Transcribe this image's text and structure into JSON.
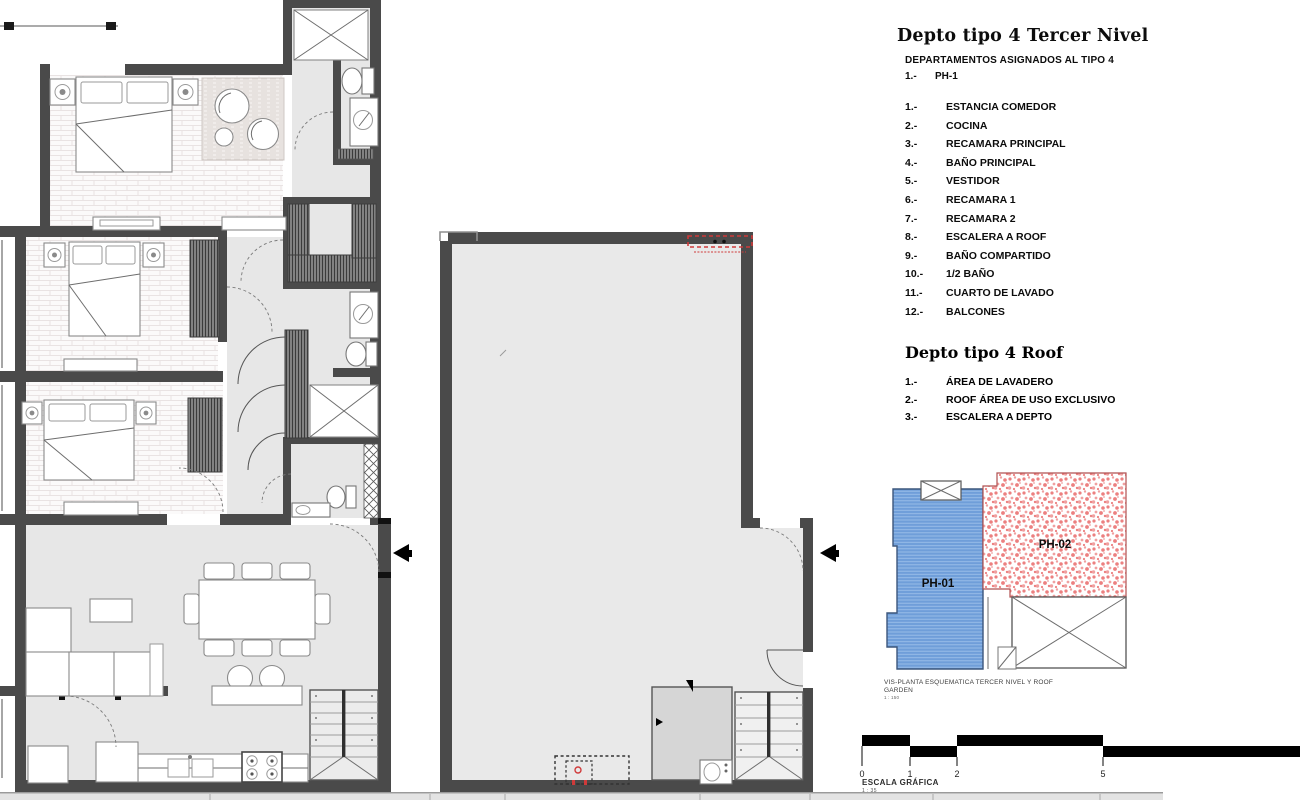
{
  "legend": {
    "title": "Depto tipo 4 Tercer Nivel",
    "subtitle": "DEPARTAMENTOS ASIGNADOS AL TIPO 4",
    "assignment": {
      "num": "1.-",
      "label": "PH-1"
    },
    "rooms": [
      {
        "num": "1.-",
        "label": "ESTANCIA COMEDOR"
      },
      {
        "num": "2.-",
        "label": "COCINA"
      },
      {
        "num": "3.-",
        "label": "RECAMARA PRINCIPAL"
      },
      {
        "num": "4.-",
        "label": "BAÑO PRINCIPAL"
      },
      {
        "num": "5.-",
        "label": "VESTIDOR"
      },
      {
        "num": "6.-",
        "label": "RECAMARA 1"
      },
      {
        "num": "7.-",
        "label": "RECAMARA 2"
      },
      {
        "num": "8.-",
        "label": "ESCALERA A ROOF"
      },
      {
        "num": "9.-",
        "label": "BAÑO COMPARTIDO"
      },
      {
        "num": "10.-",
        "label": "1/2 BAÑO"
      },
      {
        "num": "11.-",
        "label": "CUARTO DE LAVADO"
      },
      {
        "num": "12.-",
        "label": "BALCONES"
      }
    ],
    "roof_title": "Depto tipo 4 Roof",
    "roof_rooms": [
      {
        "num": "1.-",
        "label": "ÁREA DE LAVADERO"
      },
      {
        "num": "2.-",
        "label": "ROOF ÁREA DE USO EXCLUSIVO"
      },
      {
        "num": "3.-",
        "label": "ESCALERA A DEPTO"
      }
    ]
  },
  "schematic": {
    "ph01_label": "PH-01",
    "ph02_label": "PH-02",
    "caption_line1": "VIS-PLANTA ESQUEMATICA TERCER NIVEL Y ROOF",
    "caption_line2": "GARDEN",
    "caption_scale": "1 : 150"
  },
  "scale_bar": {
    "ticks": [
      "0",
      "1",
      "2",
      "5"
    ],
    "label": "ESCALA GRÁFICA",
    "ratio": "1 : 35"
  },
  "colors": {
    "wall": "#4a4a4a",
    "floor": "#e7e7e7",
    "ph01_fill": "#6f9ed9",
    "ph02_speckle": "#ec8080",
    "red_note": "#d03a3a"
  }
}
